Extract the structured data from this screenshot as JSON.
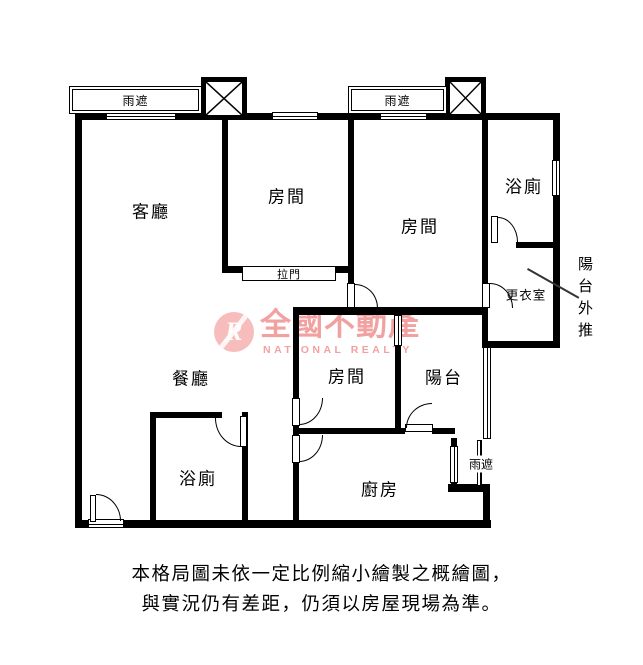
{
  "labels": {
    "living": "客廳",
    "dining": "餐廳",
    "room": "房間",
    "bath": "浴廁",
    "balcony": "陽台",
    "kitchen": "廚房",
    "closet": "更衣室",
    "canopy": "雨遮",
    "sliding_door": "拉門",
    "balcony_extension": "陽台外推"
  },
  "watermark": {
    "logo_letter": "R",
    "brand": "全國不動產",
    "brand_en": "NATIONAL REALTY",
    "brand_color": "#ed7d7d"
  },
  "disclaimer": {
    "line1": "本格局圖未依一定比例縮小繪製之概繪圖，",
    "line2": "與實況仍有差距，仍須以房屋現場為準。"
  }
}
